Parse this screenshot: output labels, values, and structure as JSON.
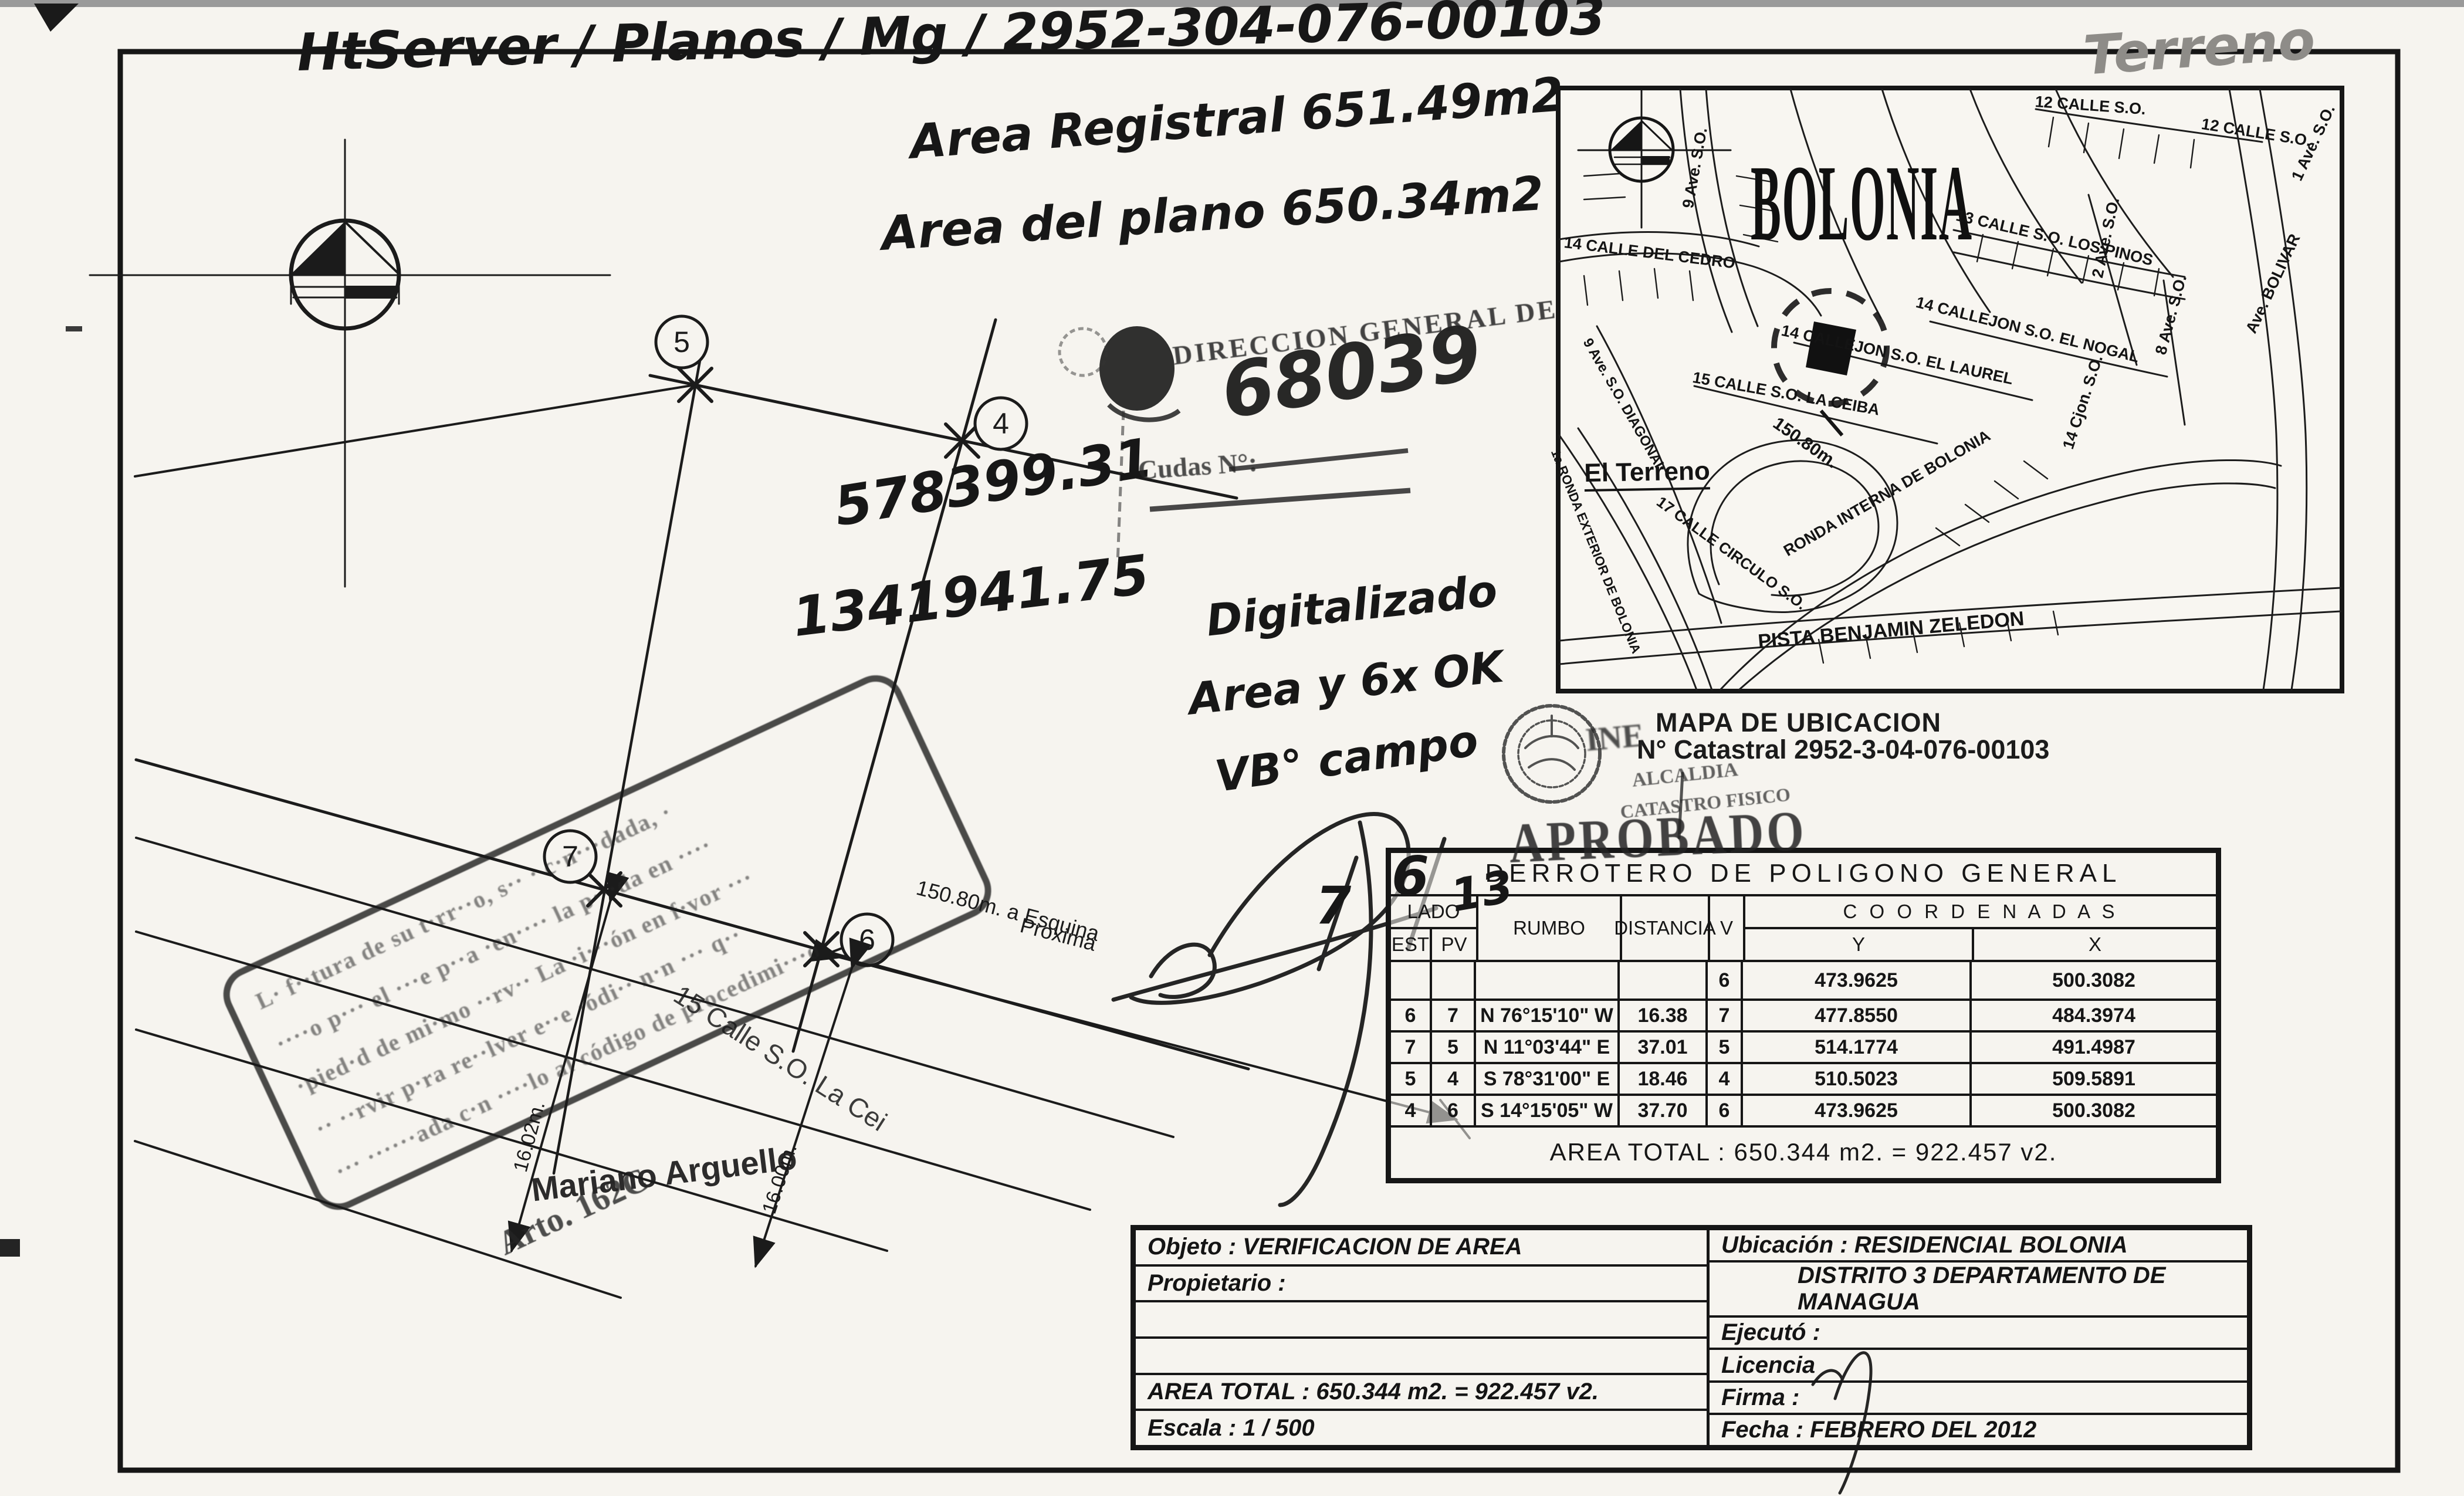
{
  "page": {
    "top_note": "HtServer / Planos / Mg / 2952-304-076-00103",
    "pencil_note": "Terreno",
    "area_registral": "Area Registral 651.49m2",
    "area_plano": "Area del plano 650.34m2",
    "coord_hand_1": "578399.31",
    "coord_hand_2": "1341941.75",
    "digitalizado_1": "Digitalizado",
    "digitalizado_2": "Area y 6x OK",
    "digitalizado_3": "VB° campo",
    "hand_7": "7",
    "hand_6": "6",
    "hand_13": "13"
  },
  "stamps": {
    "direccion": "DIRECCION GENERAL DE",
    "numero_hand": "68039",
    "cudas": "Cudas N°:",
    "ine": "INE",
    "alcaldia": "ALCALDIA",
    "catastro_fisico": "CATASTRO FISICO",
    "aprobado": "APROBADO"
  },
  "plot": {
    "vertex_5": "5",
    "vertex_4": "4",
    "vertex_7": "7",
    "vertex_6": "6",
    "dim_150_line1": "150.80m. a Esquina",
    "dim_150_line2": "Proxima",
    "dim_1602": "16.02m.",
    "dim_1600": "16.00m.",
    "street": "15 Calle S.O. La Cei",
    "owner": "Mariano Arguello",
    "arto": "Arto. 162C",
    "stamp_lines": [
      "L· f··tura de su t·rr··o, s·· · c·n···dada, ·",
      "····o p··· el ···e p··a ·en···· la p···da en ····",
      "·pied·d de mi·mo ··rv·· La ·i···ón en f·vor ···",
      "·· ··rvir p·ra re··lver e··e ·ódi·· n·n ··· q··",
      "··· ······ada c·n ····lo al código de procedimi···o"
    ]
  },
  "map": {
    "district_title": "BOLONIA",
    "caption": "MAPA DE UBICACION",
    "catastral": "N° Catastral 2952-3-04-076-00103",
    "terreno_label": "El Terreno",
    "labels": [
      {
        "text": "12 CALLE S.O."
      },
      {
        "text": "12 CALLE S.O."
      },
      {
        "text": "14 CALLE DEL CEDRO"
      },
      {
        "text": "9 Ave. S.O."
      },
      {
        "text": "13 CALLE S.O. LOS PINOS"
      },
      {
        "text": "2 Ave. S.O."
      },
      {
        "text": "1 Ave. S.O."
      },
      {
        "text": "Ave. BOLIVAR"
      },
      {
        "text": "14 CALLEJON S.O. EL NOGAL"
      },
      {
        "text": "14 CALLEJON S.O. EL LAUREL"
      },
      {
        "text": "15 CALLE S.O. LA CEIBA"
      },
      {
        "text": "14 Cjon. S.O."
      },
      {
        "text": "150.80m."
      },
      {
        "text": "9 Ave. S.O. DIAGONAL"
      },
      {
        "text": "1a RONDA EXTERIOR DE BOLONIA"
      },
      {
        "text": "17 CALLE CIRCULO S.O."
      },
      {
        "text": "RONDA INTERNA DE BOLONIA"
      },
      {
        "text": "PISTA BENJAMIN ZELEDON"
      },
      {
        "text": "8 Ave. S.O."
      }
    ]
  },
  "derrotero": {
    "title": "DERROTERO DE POLIGONO GENERAL",
    "headers": {
      "lado": "LADO",
      "est": "EST",
      "pv": "PV",
      "rumbo": "RUMBO",
      "distancia": "DISTANCIA",
      "v": "V",
      "coordenadas": "C O O R D E N A D A S",
      "y": "Y",
      "x": "X"
    },
    "rows": [
      {
        "est": "",
        "pv": "",
        "rumbo": "",
        "dist": "",
        "v": "6",
        "y": "473.9625",
        "x": "500.3082"
      },
      {
        "est": "6",
        "pv": "7",
        "rumbo": "N 76°15'10\" W",
        "dist": "16.38",
        "v": "7",
        "y": "477.8550",
        "x": "484.3974"
      },
      {
        "est": "7",
        "pv": "5",
        "rumbo": "N 11°03'44\" E",
        "dist": "37.01",
        "v": "5",
        "y": "514.1774",
        "x": "491.4987"
      },
      {
        "est": "5",
        "pv": "4",
        "rumbo": "S 78°31'00\" E",
        "dist": "18.46",
        "v": "4",
        "y": "510.5023",
        "x": "509.5891"
      },
      {
        "est": "4",
        "pv": "6",
        "rumbo": "S 14°15'05\" W",
        "dist": "37.70",
        "v": "6",
        "y": "473.9625",
        "x": "500.3082"
      }
    ],
    "area_total": "AREA TOTAL : 650.344 m2. = 922.457 v2."
  },
  "info": {
    "objeto": "Objeto : VERIFICACION DE AREA",
    "propietario": "Propietario :",
    "blank1": "",
    "blank2": "",
    "area_total": "AREA TOTAL : 650.344 m2. = 922.457 v2.",
    "escala": "Escala :   1 / 500",
    "ubicacion": "Ubicación : RESIDENCIAL BOLONIA",
    "distrito": "DISTRITO 3 DEPARTAMENTO DE MANAGUA",
    "ejecuto": "Ejecutó :",
    "licencia": "Licencia",
    "firma": "Firma :",
    "fecha": "Fecha :   FEBRERO DEL 2012"
  }
}
